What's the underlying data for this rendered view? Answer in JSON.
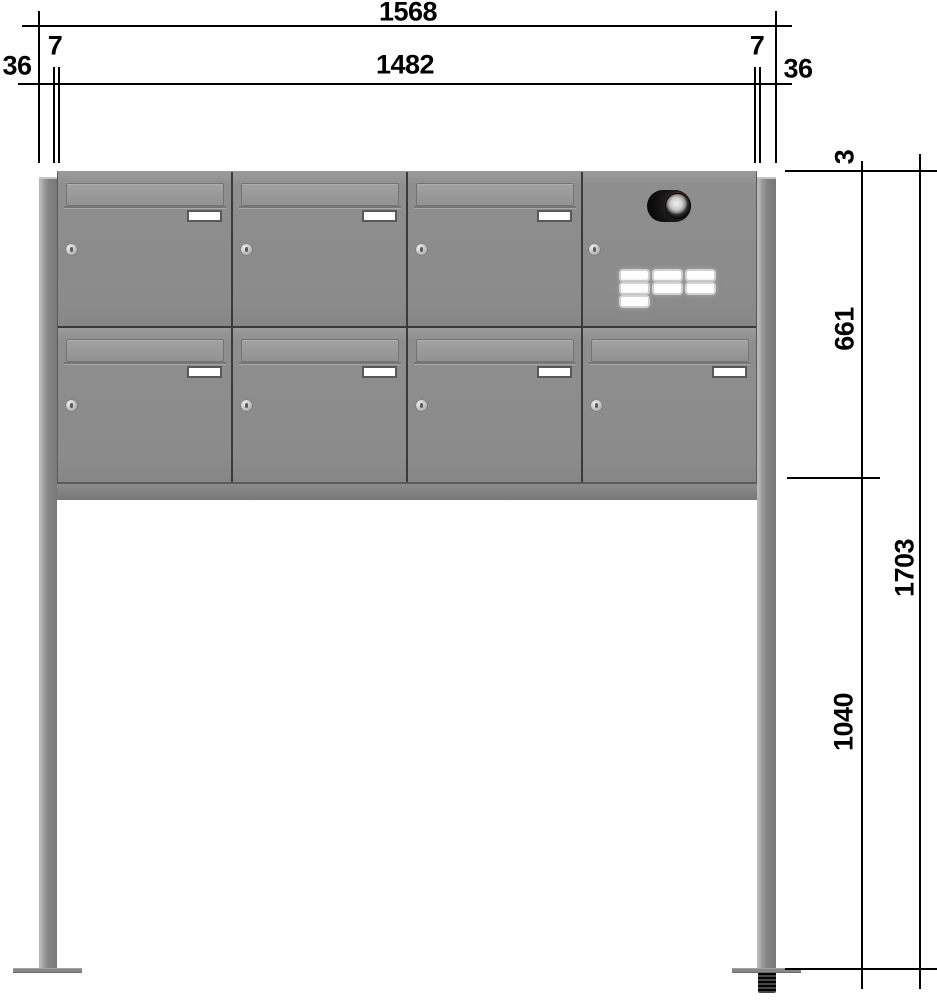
{
  "dimensions": {
    "overall_width": "1568",
    "body_width": "1482",
    "side_offset_left": "36",
    "side_offset_right": "36",
    "post_gap_left": "7",
    "post_gap_right": "7",
    "top_clearance": "3",
    "cabinet_height": "661",
    "post_ground_height": "1040",
    "total_height": "1703"
  },
  "cabinet": {
    "rows": 2,
    "columns": 4,
    "mailbox_count": 7,
    "bell_button_count": 7,
    "has_camera_intercom": true,
    "colors": {
      "door_gray": "#8d8d8d",
      "frame_dark": "#3a3a3a",
      "bottom_rail": "#7a7a7a",
      "post_gray": "#8a8a8a",
      "name_plate_frame": "#585858",
      "dimension_lines": "#000000"
    }
  }
}
